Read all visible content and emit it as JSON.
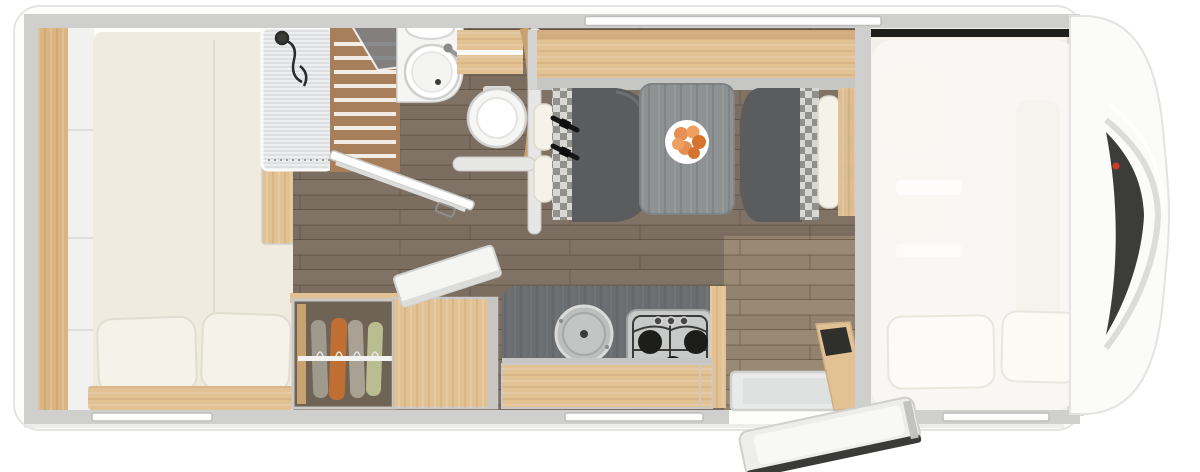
{
  "meta": {
    "type": "floorplan",
    "description": "Top-down floor plan rendering of a motorhome interior with rear bedroom, bathroom with shower, dinette, kitchen, entrance door and driver cab with drop-down bed"
  },
  "palette": {
    "body": "#fdfdfb",
    "body_edge": "#e4e4e2",
    "wall": "#cfcfcd",
    "wall_light": "#e6e6e4",
    "wood": "#e2c193",
    "wood_dark": "#c9a271",
    "headboard": "#dab581",
    "mattress": "#efecdf",
    "pillow": "#f5f2e9",
    "floor": "#7b6d60",
    "floor_light": "#a8937a",
    "seat": "#5a5c5e",
    "table": "#8e9192",
    "counter": "#6b6e70",
    "hob": "#c8cac9",
    "burner": "#1d1d1b",
    "fixture_white": "#f5f5f3",
    "glass": "#e4e6e8",
    "slat": "#a87f5b",
    "shelf_gray": "#c6c6c4",
    "check_a": "#d9d8d4",
    "check_b": "#90908c",
    "overlay_bed": "#faf8f3",
    "windshield": "#2b2b29",
    "trim": "#d8d8d6",
    "red_marker": "#cf3a28",
    "door_seal": "#3a3a38",
    "door_face": "#ededeb",
    "tv": "#2f2f2d",
    "belt": "#151515",
    "clothes_1": "#a09a8c",
    "clothes_2": "#c06f33",
    "clothes_3": "#a8a194",
    "clothes_4": "#b9bd8f",
    "fruit_a": "#e59052",
    "fruit_b": "#d4742f",
    "fruit_c": "#ef9f5e"
  },
  "rooms": {
    "rear_bedroom": {
      "label": "rear-bedroom",
      "fixtures": [
        "double-bed",
        "pillows",
        "headboard-panel",
        "side-cabinets",
        "foot-rail",
        "bedside-table"
      ]
    },
    "bathroom": {
      "label": "bathroom",
      "fixtures": [
        "shower-cabin",
        "teak-grate",
        "glass-door",
        "washbasin",
        "faucet",
        "vanity-cabinet",
        "toilet",
        "open-bathroom-door",
        "partition-wall"
      ]
    },
    "dinette": {
      "label": "dinette",
      "fixtures": [
        "overhead-shelf",
        "window",
        "left-bench",
        "right-bench",
        "seat-belts",
        "table",
        "fruit-plate"
      ]
    },
    "kitchen": {
      "label": "kitchen",
      "fixtures": [
        "worktop",
        "sink-with-lid",
        "gas-hob",
        "drawer-unit",
        "top-loading-box-open-lid",
        "wardrobe-with-clothes"
      ]
    },
    "entrance": {
      "label": "entrance",
      "fixtures": [
        "entry-step",
        "open-entry-door",
        "tv-panel"
      ]
    },
    "cab": {
      "label": "driver-cab",
      "fixtures": [
        "drop-down-bed",
        "pillows",
        "cab-seats",
        "dashboard",
        "windshield",
        "mirror-marker"
      ]
    }
  },
  "counts": {
    "hob_burners": 3,
    "hob_control_knobs": 3,
    "bed_pillows": 2,
    "cab_bed_pillows": 2,
    "hanging_clothes": 4,
    "fruits_on_plate": 6,
    "window_slots": 4,
    "seat_belts": 2
  }
}
